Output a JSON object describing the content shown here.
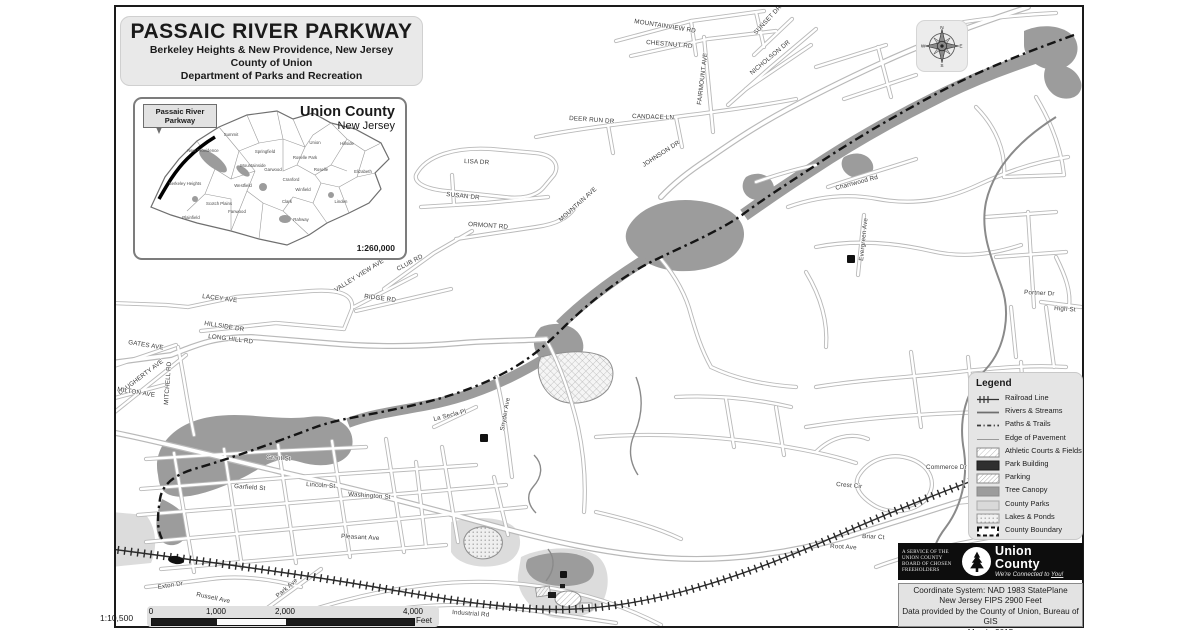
{
  "title_block": {
    "title": "PASSAIC RIVER PARKWAY",
    "subtitle1": "Berkeley Heights & New Providence, New Jersey",
    "subtitle2": "County of Union",
    "subtitle3": "Department of Parks and Recreation"
  },
  "inset": {
    "callout_line1": "Passaic River",
    "callout_line2": "Parkway",
    "title": "Union County",
    "subtitle": "New Jersey",
    "scale": "1:260,000",
    "towns": [
      {
        "name": "Summit",
        "x": 96,
        "y": 37
      },
      {
        "name": "New Providence",
        "x": 68,
        "y": 53
      },
      {
        "name": "Berkeley Heights",
        "x": 50,
        "y": 86
      },
      {
        "name": "Springfield",
        "x": 130,
        "y": 54
      },
      {
        "name": "Mountainside",
        "x": 118,
        "y": 68
      },
      {
        "name": "Union",
        "x": 180,
        "y": 45
      },
      {
        "name": "Hillside",
        "x": 212,
        "y": 46
      },
      {
        "name": "Elizabeth",
        "x": 228,
        "y": 74
      },
      {
        "name": "Roselle Park",
        "x": 170,
        "y": 60
      },
      {
        "name": "Garwood",
        "x": 138,
        "y": 72
      },
      {
        "name": "Westfield",
        "x": 108,
        "y": 88
      },
      {
        "name": "Cranford",
        "x": 156,
        "y": 82
      },
      {
        "name": "Roselle",
        "x": 186,
        "y": 72
      },
      {
        "name": "Scotch Plains",
        "x": 84,
        "y": 106
      },
      {
        "name": "Fanwood",
        "x": 102,
        "y": 114
      },
      {
        "name": "Plainfield",
        "x": 56,
        "y": 120
      },
      {
        "name": "Clark",
        "x": 152,
        "y": 104
      },
      {
        "name": "Winfield",
        "x": 168,
        "y": 92
      },
      {
        "name": "Rahway",
        "x": 166,
        "y": 122
      },
      {
        "name": "Linden",
        "x": 206,
        "y": 104
      }
    ]
  },
  "compass": {
    "n": "N",
    "e": "E",
    "s": "S",
    "w": "W"
  },
  "legend": {
    "title": "Legend",
    "items": [
      {
        "label": "Railroad Line",
        "symbol": "railroad"
      },
      {
        "label": "Rivers & Streams",
        "symbol": "river"
      },
      {
        "label": "Paths & Trails",
        "symbol": "trail"
      },
      {
        "label": "Edge of Pavement",
        "symbol": "pavement"
      },
      {
        "label": "Athletic Courts & Fields",
        "symbol": "athletic"
      },
      {
        "label": "Park Building",
        "symbol": "building"
      },
      {
        "label": "Parking",
        "symbol": "parking"
      },
      {
        "label": "Tree Canopy",
        "symbol": "canopy"
      },
      {
        "label": "County Parks",
        "symbol": "parks"
      },
      {
        "label": "Lakes & Ponds",
        "symbol": "lakes"
      },
      {
        "label": "County Boundary",
        "symbol": "boundary"
      }
    ]
  },
  "map": {
    "street_labels": [
      {
        "text": "MOUNTAINVIEW RD",
        "x": 518,
        "y": 16,
        "r": 9
      },
      {
        "text": "CHESTNUT RD",
        "x": 530,
        "y": 37,
        "r": 5
      },
      {
        "text": "SUNSET DR",
        "x": 640,
        "y": 28,
        "r": -47
      },
      {
        "text": "NICHOLSON DR",
        "x": 636,
        "y": 68,
        "r": -40
      },
      {
        "text": "FAIRMOUNT AVE",
        "x": 585,
        "y": 98,
        "r": -83
      },
      {
        "text": "DEER RUN DR",
        "x": 453,
        "y": 113,
        "r": 4
      },
      {
        "text": "CANDACE LN",
        "x": 516,
        "y": 111,
        "r": 2
      },
      {
        "text": "JOHNSON DR",
        "x": 528,
        "y": 160,
        "r": -33
      },
      {
        "text": "LISA DR",
        "x": 348,
        "y": 156,
        "r": 3
      },
      {
        "text": "SUSAN DR",
        "x": 330,
        "y": 189,
        "r": 6
      },
      {
        "text": "ORMONT RD",
        "x": 352,
        "y": 219,
        "r": 4
      },
      {
        "text": "MOUNTAIN AVE",
        "x": 445,
        "y": 215,
        "r": -42
      },
      {
        "text": "CLUB RD",
        "x": 282,
        "y": 264,
        "r": -28
      },
      {
        "text": "VALLEY VIEW AVE",
        "x": 220,
        "y": 285,
        "r": -32
      },
      {
        "text": "RIDGE RD",
        "x": 248,
        "y": 291,
        "r": 7
      },
      {
        "text": "LACEY AVE",
        "x": 86,
        "y": 291,
        "r": 7
      },
      {
        "text": "HILLSIDE DR",
        "x": 88,
        "y": 318,
        "r": 9
      },
      {
        "text": "LONG HILL RD",
        "x": 92,
        "y": 331,
        "r": 7
      },
      {
        "text": "GATES AVE",
        "x": 12,
        "y": 337,
        "r": 9
      },
      {
        "text": "DAUGHERTY AVE",
        "x": 4,
        "y": 388,
        "r": -37
      },
      {
        "text": "MITCHELL RD",
        "x": 52,
        "y": 398,
        "r": -86
      },
      {
        "text": "MILTON AVE",
        "x": 1,
        "y": 384,
        "r": 9
      },
      {
        "text": "Grant St",
        "x": 150,
        "y": 452,
        "r": 4
      },
      {
        "text": "Garfield St",
        "x": 118,
        "y": 481,
        "r": 4
      },
      {
        "text": "Lincoln St",
        "x": 190,
        "y": 479,
        "r": 4
      },
      {
        "text": "Washington St",
        "x": 232,
        "y": 489,
        "r": 4
      },
      {
        "text": "Pleasant Ave",
        "x": 225,
        "y": 531,
        "r": 3
      },
      {
        "text": "La Secla Pl",
        "x": 318,
        "y": 414,
        "r": -14
      },
      {
        "text": "Snyder Ave",
        "x": 388,
        "y": 424,
        "r": -80
      },
      {
        "text": "Charnwood Rd",
        "x": 720,
        "y": 183,
        "r": -15
      },
      {
        "text": "Evergreen Ave",
        "x": 747,
        "y": 254,
        "r": -84
      },
      {
        "text": "Portner Dr",
        "x": 908,
        "y": 287,
        "r": 3
      },
      {
        "text": "High St",
        "x": 938,
        "y": 303,
        "r": 4
      },
      {
        "text": "Commerce Dr",
        "x": 810,
        "y": 462,
        "r": 0
      },
      {
        "text": "Crest Cir",
        "x": 720,
        "y": 479,
        "r": 5
      },
      {
        "text": "Briar Ct",
        "x": 746,
        "y": 531,
        "r": 3
      },
      {
        "text": "Root Ave",
        "x": 714,
        "y": 541,
        "r": 3
      },
      {
        "text": "Exton Dr",
        "x": 42,
        "y": 582,
        "r": -9
      },
      {
        "text": "Russell Ave",
        "x": 80,
        "y": 589,
        "r": 12
      },
      {
        "text": "Park Ave",
        "x": 162,
        "y": 591,
        "r": -41
      },
      {
        "text": "Industrial Rd",
        "x": 336,
        "y": 607,
        "r": 4
      }
    ]
  },
  "scale_bar": {
    "ratio": "1:10,500",
    "unit": "Feet",
    "ticks": [
      {
        "label": "0",
        "x": 4
      },
      {
        "label": "1,000",
        "x": 69
      },
      {
        "label": "2,000",
        "x": 138
      },
      {
        "label": "4,000",
        "x": 266
      }
    ]
  },
  "banner": {
    "service_lines": [
      "A SERVICE OF THE",
      "UNION COUNTY",
      "BOARD OF CHOSEN",
      "FREEHOLDERS"
    ],
    "name": "Union County",
    "tagline_prefix": "We're Connected to ",
    "tagline_emphasis": "You!"
  },
  "attribution": {
    "lines": [
      "Coordinate System: NAD 1983 StatePlane",
      "New Jersey FIPS 2900 Feet",
      "Data provided by the County of Union, Bureau of GIS",
      "March, 2015"
    ]
  },
  "colors": {
    "tree_canopy": "#9c9c9c",
    "county_parks": "#dcdcdc",
    "road_casing": "#b9b9b9",
    "county_boundary": "#151515"
  }
}
